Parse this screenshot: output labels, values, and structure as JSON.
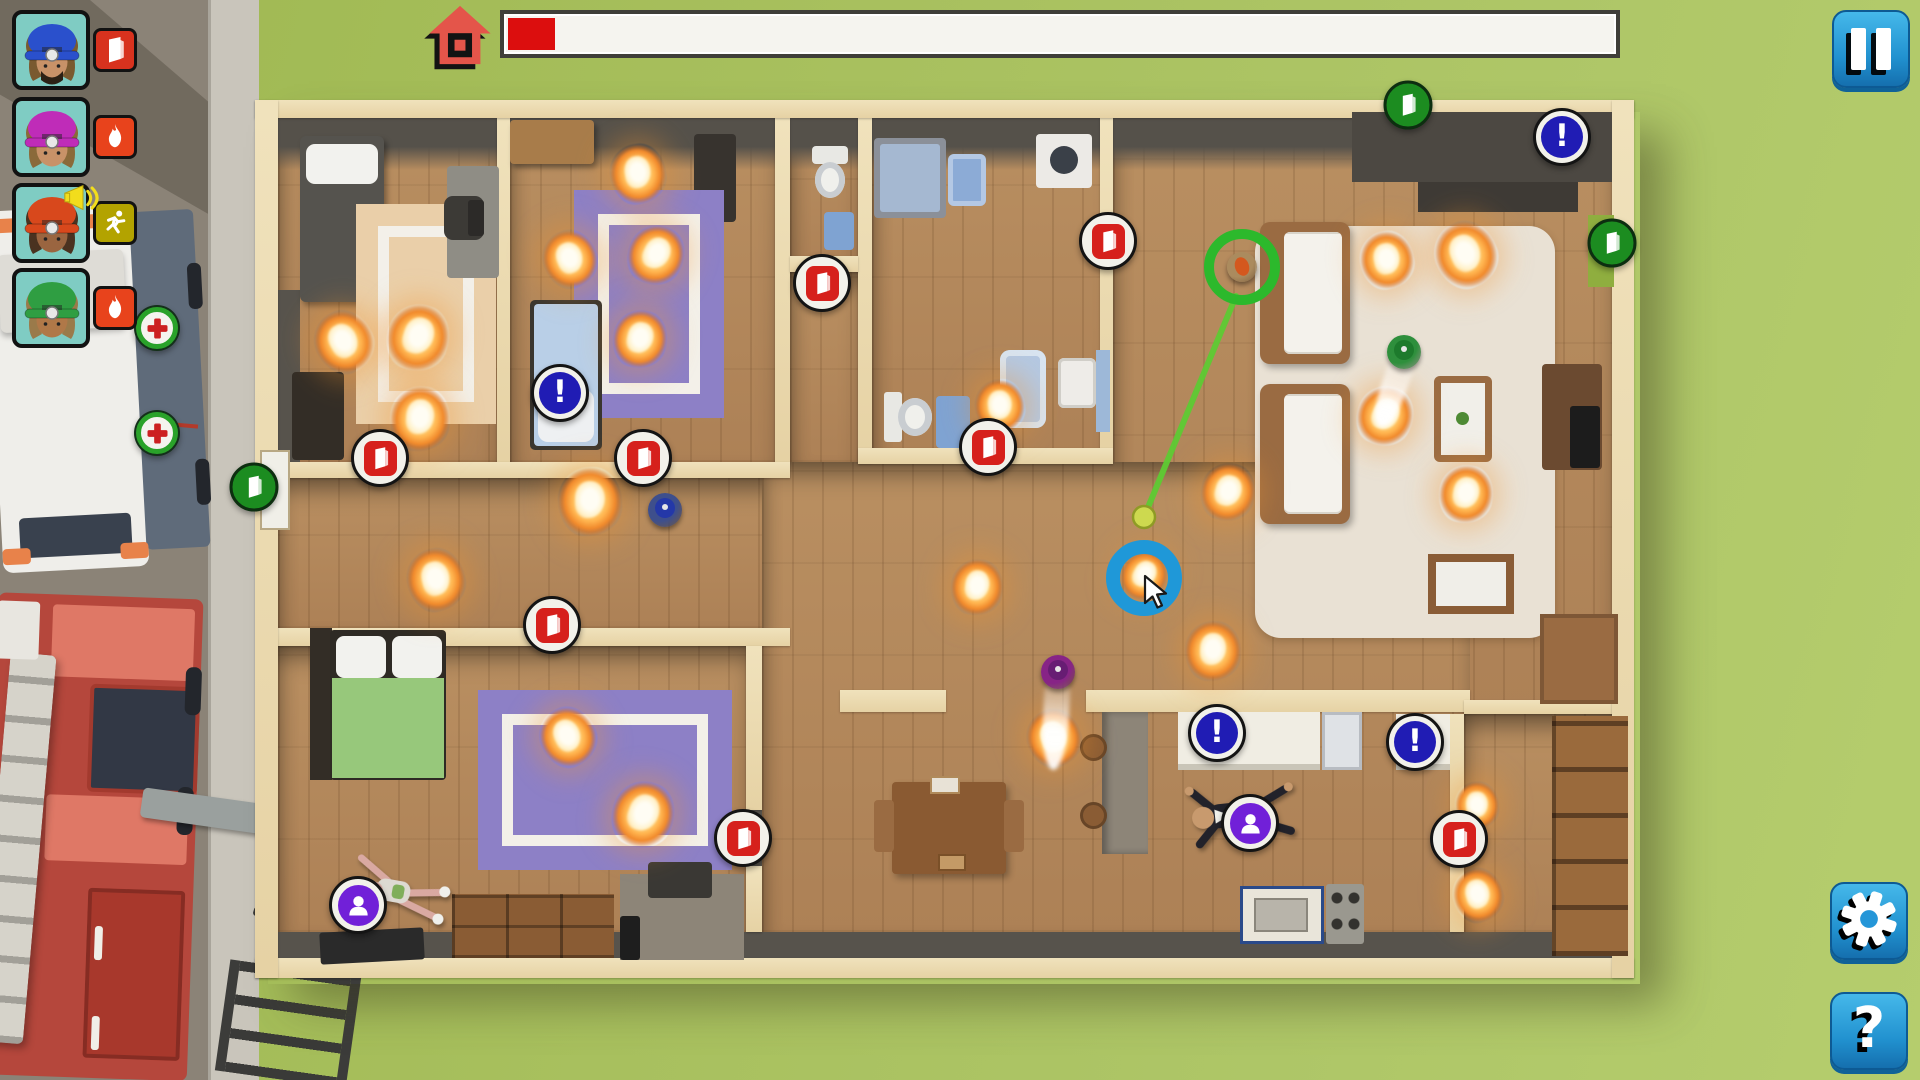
{
  "hud": {
    "progress_bar": {
      "fill_pct": 4.2,
      "fill_color": "#dc0e0e",
      "objective_icon": "house-icon"
    },
    "pause_button": {
      "icon": "pause-icon"
    },
    "settings_button": {
      "icon": "gear-icon"
    },
    "help_button": {
      "icon": "question-icon",
      "glyph": "?"
    },
    "crew": [
      {
        "helmet_color": "#2a50cc",
        "hair_color": "#7a5a30",
        "skin_color": "#c89268",
        "beard": true,
        "status_icon": "door-icon",
        "status_bg": "#d8321e",
        "alert_icon": null
      },
      {
        "helmet_color": "#bf2cb8",
        "hair_color": "#8a6a3a",
        "skin_color": "#c89268",
        "beard": false,
        "status_icon": "flame-icon",
        "status_bg": "#e8431c",
        "alert_icon": null
      },
      {
        "helmet_color": "#d8481c",
        "hair_color": "#4a3220",
        "skin_color": "#9a6540",
        "beard": false,
        "status_icon": "runner-icon",
        "status_bg": "#b3a300",
        "alert_icon": "megaphone-icon"
      },
      {
        "helmet_color": "#2f9e42",
        "hair_color": "#9a7a4a",
        "skin_color": "#b07848",
        "beard": false,
        "status_icon": "flame-icon",
        "status_bg": "#e8431c",
        "alert_icon": null
      }
    ]
  },
  "map": {
    "markers": [
      {
        "type": "door-red",
        "x": 822,
        "y": 283
      },
      {
        "type": "door-red",
        "x": 1108,
        "y": 241
      },
      {
        "type": "door-red",
        "x": 988,
        "y": 447
      },
      {
        "type": "door-red",
        "x": 380,
        "y": 458
      },
      {
        "type": "door-red",
        "x": 643,
        "y": 458
      },
      {
        "type": "door-red",
        "x": 552,
        "y": 625
      },
      {
        "type": "door-red",
        "x": 743,
        "y": 838
      },
      {
        "type": "door-red",
        "x": 1459,
        "y": 839
      },
      {
        "type": "door-green",
        "x": 1408,
        "y": 105
      },
      {
        "type": "door-green",
        "x": 1612,
        "y": 243
      },
      {
        "type": "door-green",
        "x": 254,
        "y": 487
      },
      {
        "type": "alert",
        "x": 560,
        "y": 393
      },
      {
        "type": "alert",
        "x": 1562,
        "y": 137
      },
      {
        "type": "alert",
        "x": 1217,
        "y": 733
      },
      {
        "type": "alert",
        "x": 1415,
        "y": 742
      },
      {
        "type": "victim",
        "x": 358,
        "y": 905
      },
      {
        "type": "victim",
        "x": 1250,
        "y": 823
      },
      {
        "type": "medical",
        "x": 157,
        "y": 328
      },
      {
        "type": "medical",
        "x": 157,
        "y": 433
      }
    ],
    "fires": [
      {
        "x": 344,
        "y": 345,
        "s": 58
      },
      {
        "x": 418,
        "y": 341,
        "s": 62
      },
      {
        "x": 420,
        "y": 422,
        "s": 60
      },
      {
        "x": 638,
        "y": 177,
        "s": 56
      },
      {
        "x": 570,
        "y": 262,
        "s": 54
      },
      {
        "x": 656,
        "y": 258,
        "s": 56
      },
      {
        "x": 640,
        "y": 342,
        "s": 54
      },
      {
        "x": 590,
        "y": 505,
        "s": 64
      },
      {
        "x": 436,
        "y": 583,
        "s": 58
      },
      {
        "x": 568,
        "y": 740,
        "s": 56
      },
      {
        "x": 643,
        "y": 818,
        "s": 62
      },
      {
        "x": 977,
        "y": 590,
        "s": 52
      },
      {
        "x": 1000,
        "y": 409,
        "s": 50
      },
      {
        "x": 1054,
        "y": 741,
        "s": 54
      },
      {
        "x": 1144,
        "y": 578,
        "s": 46
      },
      {
        "x": 1228,
        "y": 495,
        "s": 54
      },
      {
        "x": 1213,
        "y": 654,
        "s": 56
      },
      {
        "x": 1387,
        "y": 263,
        "s": 54
      },
      {
        "x": 1466,
        "y": 258,
        "s": 62
      },
      {
        "x": 1385,
        "y": 419,
        "s": 56
      },
      {
        "x": 1466,
        "y": 497,
        "s": 54
      },
      {
        "x": 1477,
        "y": 808,
        "s": 44
      },
      {
        "x": 1478,
        "y": 898,
        "s": 50
      }
    ],
    "characters": [
      {
        "type": "civilian-carry",
        "x": 1242,
        "y": 267,
        "gear_color": "#ab8b5e",
        "chest_color": "#d4581e"
      },
      {
        "type": "firefighter",
        "x": 1404,
        "y": 352,
        "suit_color": "#2e8f3c",
        "helmet_color": "#1d7a2c",
        "spray": {
          "angle": 19,
          "length": 72
        }
      },
      {
        "type": "firefighter",
        "x": 665,
        "y": 510,
        "suit_color": "#3e4f8c",
        "helmet_color": "#2438a8",
        "spray": null
      },
      {
        "type": "firefighter",
        "x": 1058,
        "y": 672,
        "suit_color": "#872486",
        "helmet_color": "#671d73",
        "spray": {
          "angle": 3,
          "length": 92
        }
      },
      {
        "type": "victim-down",
        "variant": "suit",
        "x": 1240,
        "y": 815,
        "rot": -6,
        "skin": "#c89a6e",
        "outfit": "#22222a"
      },
      {
        "type": "victim-down",
        "variant": "casual",
        "x": 405,
        "y": 893,
        "rot": 10,
        "skin": "#d9a9a2",
        "outfit": "#dddad2"
      }
    ],
    "selection": {
      "ring_x": 1242,
      "ring_y": 267,
      "dot_x": 1144,
      "dot_y": 517,
      "ring_color": "#2cb92c",
      "line_color": "#5ecb33",
      "dot_color": "#cdd94f"
    },
    "cursor": {
      "ring_x": 1144,
      "ring_y": 578,
      "arrow_x": 1145,
      "arrow_y": 576,
      "ring_color": "#1f98d8"
    }
  }
}
